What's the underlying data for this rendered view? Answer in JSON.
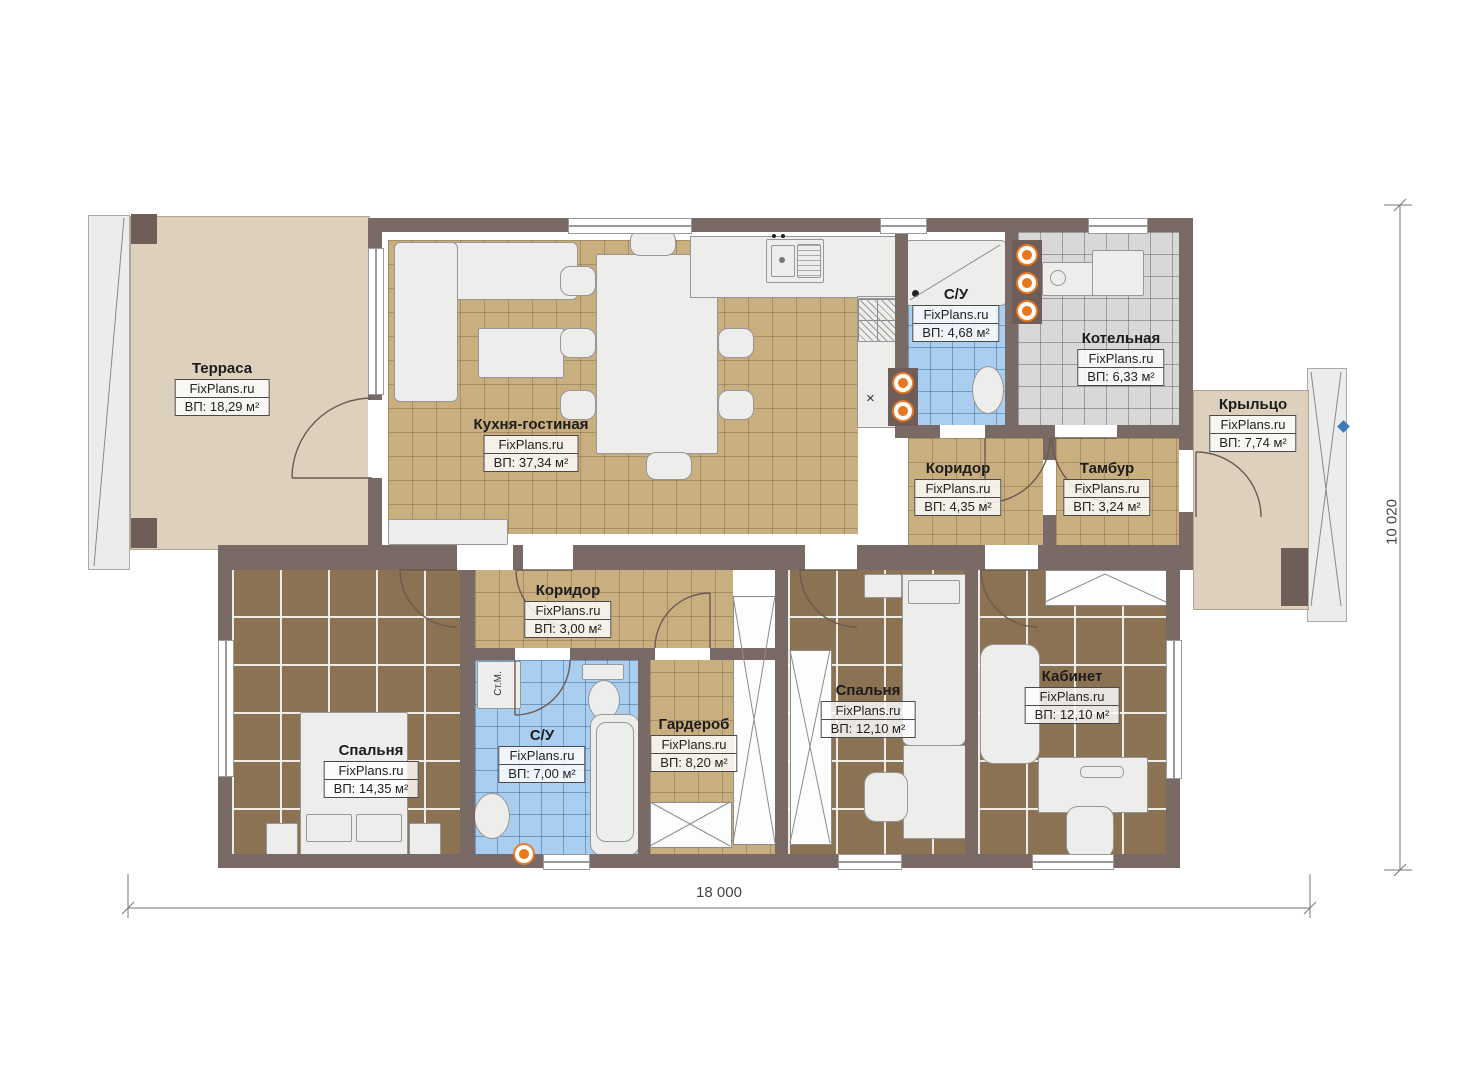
{
  "watermark": "FixPlans.ru",
  "dimensions": {
    "width": "18 000",
    "height": "10 020"
  },
  "labels": {
    "washer": "Ст.М.",
    "drain_mark": "×"
  },
  "rooms": [
    {
      "id": "terrace",
      "name": "Терраса",
      "area": "ВП: 18,29 м²"
    },
    {
      "id": "kitchen",
      "name": "Кухня-гостиная",
      "area": "ВП: 37,34 м²"
    },
    {
      "id": "su1",
      "name": "С/У",
      "area": "ВП: 4,68 м²"
    },
    {
      "id": "boiler",
      "name": "Котельная",
      "area": "ВП: 6,33 м²"
    },
    {
      "id": "porch",
      "name": "Крыльцо",
      "area": "ВП: 7,74 м²"
    },
    {
      "id": "corridor1",
      "name": "Коридор",
      "area": "ВП: 4,35 м²"
    },
    {
      "id": "tambour",
      "name": "Тамбур",
      "area": "ВП: 3,24 м²"
    },
    {
      "id": "corridor2",
      "name": "Коридор",
      "area": "ВП: 3,00 м²"
    },
    {
      "id": "bedroom1",
      "name": "Спальня",
      "area": "ВП: 14,35 м²"
    },
    {
      "id": "su2",
      "name": "С/У",
      "area": "ВП: 7,00 м²"
    },
    {
      "id": "wardrobe",
      "name": "Гардероб",
      "area": "ВП: 8,20 м²"
    },
    {
      "id": "bedroom2",
      "name": "Спальня",
      "area": "ВП: 12,10 м²"
    },
    {
      "id": "office",
      "name": "Кабинет",
      "area": "ВП: 12,10 м²"
    }
  ],
  "colors": {
    "wall": "#7a6a66",
    "terrace_floor": "#ddd1bd",
    "tile_tan": "#c9ae80",
    "floor_wood": "#8a7252",
    "tile_blue": "#a9ceef",
    "tile_gray": "#d8d8d8",
    "accent_orange": "#e8781e",
    "furniture": "#ededeb",
    "level_marker_blue": "#3d7ab8"
  }
}
